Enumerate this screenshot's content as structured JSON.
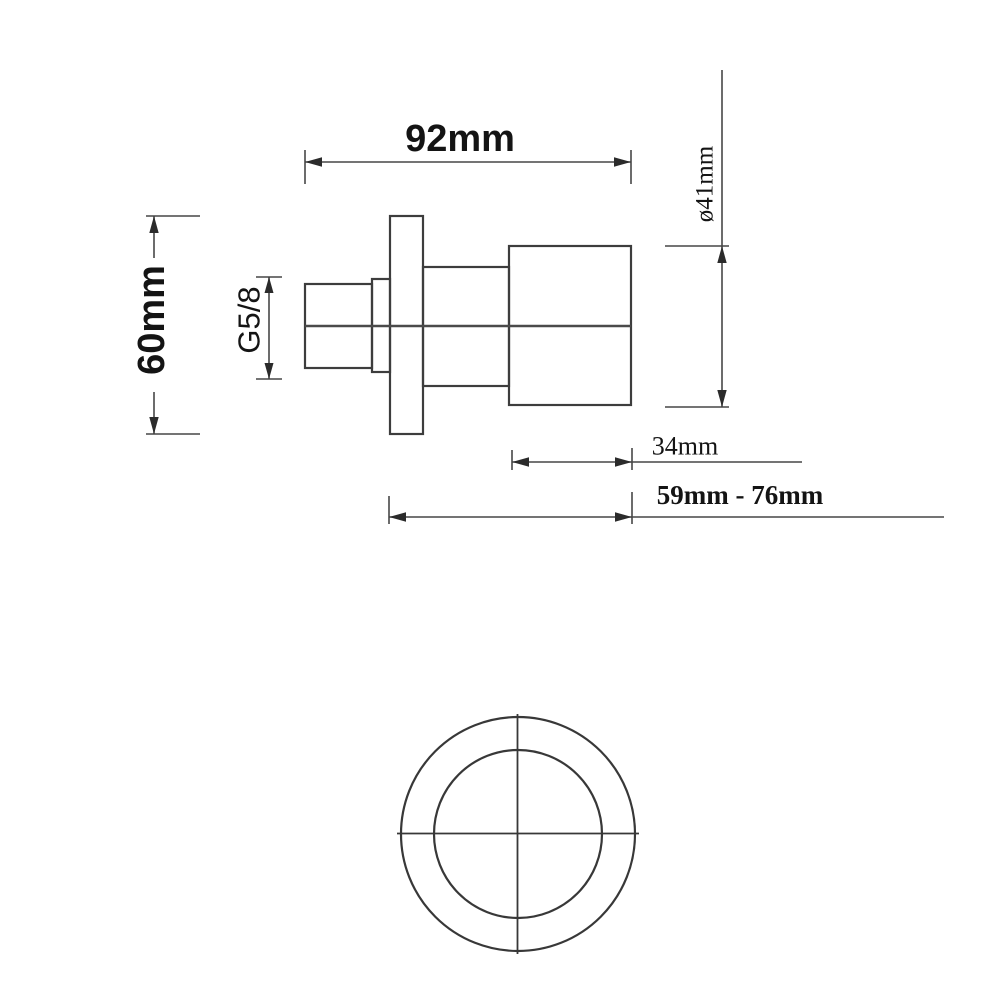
{
  "drawing": {
    "title": "shower valve technical drawing",
    "background_color": "#ffffff",
    "line_color": "#3d3d3d",
    "text_color": "#141414",
    "dimensions": {
      "total_width": "92mm",
      "flange_height": "60mm",
      "thread_size": "G5/8",
      "handle_diameter": "ø41mm",
      "handle_length": "34mm",
      "depth_range": "59mm - 76mm"
    }
  }
}
